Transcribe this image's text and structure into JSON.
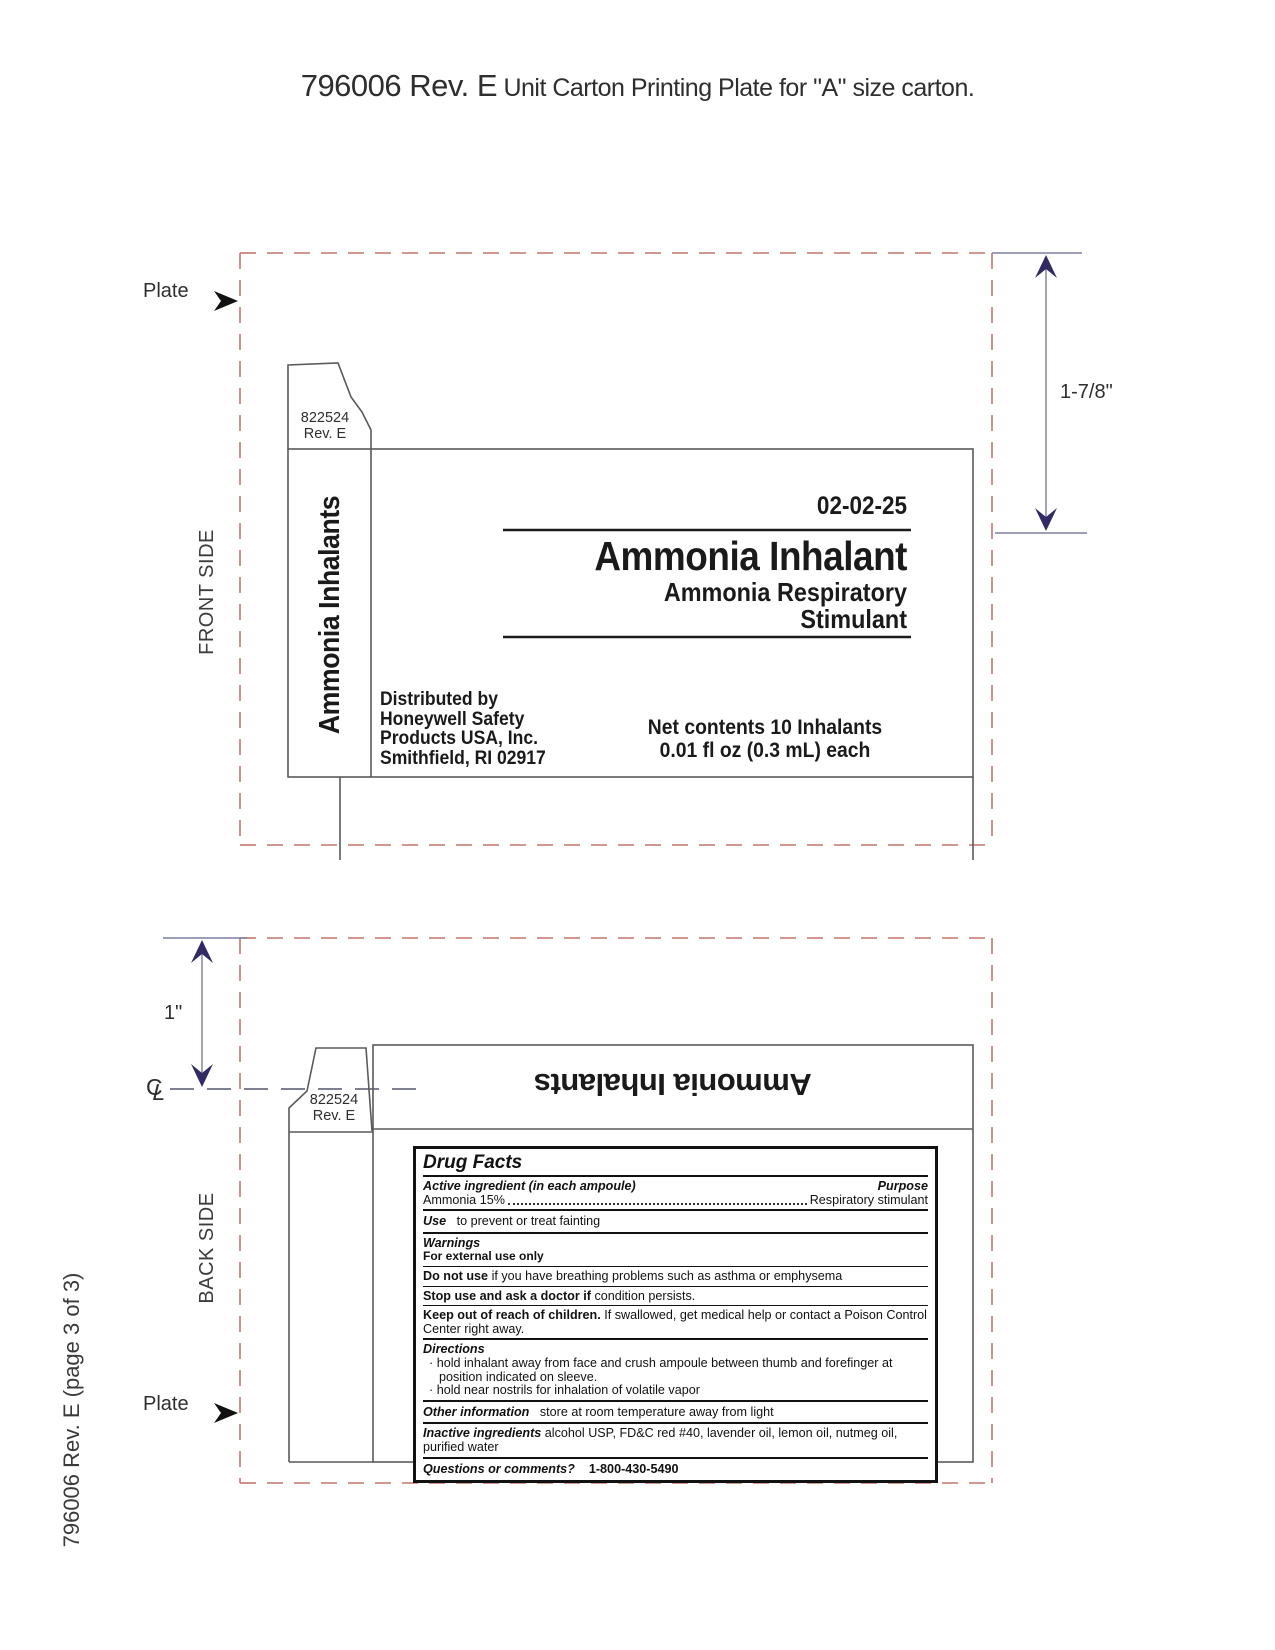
{
  "page": {
    "title_code": "796006 Rev. E",
    "title_rest": " Unit Carton Printing Plate for \"A\" size carton.",
    "footer_vertical": "796006 Rev. E (page 3 of 3)"
  },
  "colors": {
    "plate_border_dashed": "#c4766b",
    "carton_line": "#5a5a5a",
    "dimension_arrow": "#312a63",
    "dimension_line": "#7b7ea3",
    "text": "#1a1a1a"
  },
  "front": {
    "side_label": "FRONT SIDE",
    "plate_label": "Plate",
    "dim_label": "1-7/8\"",
    "tab": {
      "line1": "822524",
      "line2": "Rev. E"
    },
    "spine_title": "Ammonia Inhalants",
    "date_code": "02-02-25",
    "product_title": "Ammonia Inhalant",
    "subtitle_line1": "Ammonia Respiratory",
    "subtitle_line2": "Stimulant",
    "distributor": [
      "Distributed by",
      "Honeywell Safety",
      "Products USA, Inc.",
      "Smithfield, RI 02917"
    ],
    "net_contents_line1": "Net contents 10 Inhalants",
    "net_contents_line2": "0.01 fl oz (0.3 mL) each"
  },
  "back": {
    "side_label": "BACK SIDE",
    "plate_label": "Plate",
    "dim_label": "1\"",
    "centerline": {
      "c": "C",
      "l": "L"
    },
    "tab": {
      "line1": "822524",
      "line2": "Rev. E"
    },
    "flipped_title": "Ammonia Inhalants",
    "drug_facts": {
      "title": "Drug Facts",
      "active_header": "Active ingredient (in each ampoule)",
      "purpose_header": "Purpose",
      "active_name": "Ammonia 15%",
      "purpose_value": "Respiratory stimulant",
      "use_label": "Use",
      "use_text": "to prevent or treat fainting",
      "warnings_label": "Warnings",
      "external_use": "For external use only",
      "donotuse_bold": "Do not use",
      "donotuse_text": " if you have breathing problems such as asthma or emphysema",
      "stopuse_bold": "Stop use and ask a doctor if",
      "stopuse_text": " condition persists.",
      "keepout_bold": "Keep out of reach of children.",
      "keepout_text": " If swallowed, get medical help or contact a Poison Control Center right away.",
      "directions_label": "Directions",
      "bullet": "·",
      "directions_items": [
        "hold inhalant away from face and crush ampoule between thumb and forefinger at position indicated on sleeve.",
        "hold near nostrils for inhalation of volatile vapor"
      ],
      "other_label": "Other information",
      "other_text": "store at room temperature away from light",
      "inactive_label": "Inactive ingredients",
      "inactive_text": " alcohol USP, FD&C red #40, lavender oil, lemon oil, nutmeg oil, purified water",
      "questions_label": "Questions or comments?",
      "questions_value": "1-800-430-5490"
    }
  }
}
